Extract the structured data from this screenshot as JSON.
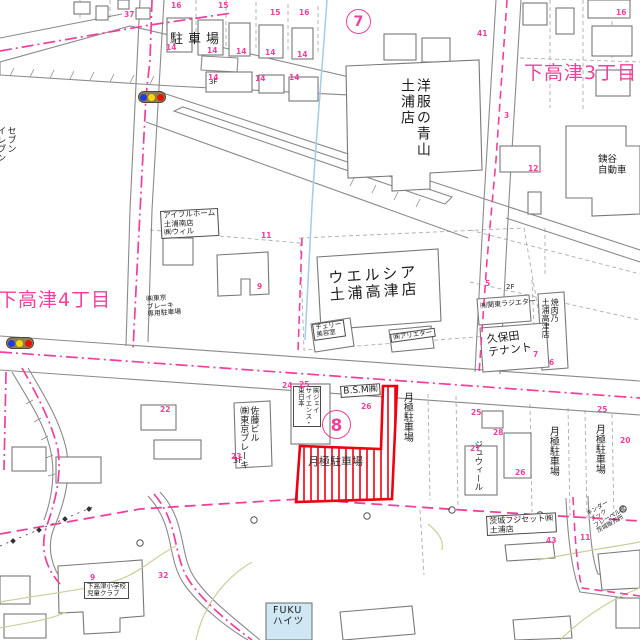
{
  "map": {
    "kind": "japanese residential map (Tsuchiura, Shimotakatsu area)",
    "highlight": "red hatched parcel - monthly parking lot"
  },
  "colors": {
    "pink": "#f23f9b",
    "red": "#ee0011",
    "text": "#1c1c1c",
    "dark": "#333333",
    "contour": "#cdcd9b",
    "water": "#a9cde8",
    "building_fill": "#cfe7f3",
    "signal_body": "#8d7f52",
    "signal_blue": "#1e3de0",
    "signal_yellow": "#f5d800",
    "signal_red": "#e81500"
  },
  "labels": [
    {
      "text": "駐車場",
      "x": 170,
      "y": 33,
      "size": 13,
      "ls": 5
    },
    {
      "text": "洋服の青山\n土浦店",
      "x": 398,
      "y": 78,
      "size": 14,
      "vertical": true,
      "ls": 2
    },
    {
      "text": "下高津3丁目",
      "x": 524,
      "y": 63,
      "size": 19,
      "color": "pink",
      "ls": 1
    },
    {
      "text": "下高津4丁目",
      "x": -2,
      "y": 290,
      "size": 19,
      "color": "pink",
      "ls": 1
    },
    {
      "text": "セブン\nイレブン",
      "x": -5,
      "y": 126,
      "size": 9,
      "vertical": true
    },
    {
      "text": "アイフルホーム\n土浦南店\n㈱ウィル",
      "x": 160,
      "y": 211,
      "size": 7.5,
      "boxed": true,
      "rot": -3
    },
    {
      "text": "ウエルシア\n土浦高津店",
      "x": 328,
      "y": 270,
      "size": 15,
      "ls": 3,
      "rot": -4,
      "align": "center"
    },
    {
      "text": "チェリー\n美容室",
      "x": 312,
      "y": 324,
      "size": 6.5,
      "boxed": true,
      "rot": -8
    },
    {
      "text": "㈱アリエター",
      "x": 390,
      "y": 334,
      "size": 6.5,
      "boxed": true,
      "rot": -8
    },
    {
      "text": "㈲関東ラジエター",
      "x": 480,
      "y": 303,
      "size": 7,
      "rot": -5
    },
    {
      "text": "焼肉乃\n土浦高津店",
      "x": 541,
      "y": 298,
      "size": 8,
      "vertical": true
    },
    {
      "text": "久保田\nテナント",
      "x": 486,
      "y": 334,
      "size": 11,
      "rot": -7
    },
    {
      "text": "銕谷\n自動車",
      "x": 598,
      "y": 155,
      "size": 9.5
    },
    {
      "text": "B.S.M㈱",
      "x": 340,
      "y": 386,
      "size": 9,
      "boxed": true,
      "rot": -4
    },
    {
      "text": "㈱ジェイ\nサイエンス・\n東日本",
      "x": 293,
      "y": 386,
      "size": 6.5,
      "vertical": true,
      "boxed": true
    },
    {
      "text": "月極駐車場",
      "x": 401,
      "y": 392,
      "size": 10,
      "vertical": true
    },
    {
      "text": "月極駐車場",
      "x": 308,
      "y": 456,
      "size": 11,
      "color": "dark"
    },
    {
      "text": "月極駐車場",
      "x": 547,
      "y": 426,
      "size": 10,
      "vertical": true
    },
    {
      "text": "月極駐車場",
      "x": 593,
      "y": 424,
      "size": 10,
      "vertical": true
    },
    {
      "text": "ジュウィール",
      "x": 472,
      "y": 440,
      "size": 8.5,
      "vertical": true
    },
    {
      "text": "佐藤ビル\n㈱東京ブレーキ",
      "x": 238,
      "y": 406,
      "size": 9,
      "vertical": true
    },
    {
      "text": "3F",
      "x": 233,
      "y": 456,
      "size": 8
    },
    {
      "text": "㈱東京\nブレーキ\n専用駐車場",
      "x": 146,
      "y": 296,
      "size": 6.8,
      "rot": -4
    },
    {
      "text": "茨城フジセット㈱\n土浦店",
      "x": 486,
      "y": 516,
      "size": 8,
      "boxed": true,
      "rot": -3
    },
    {
      "text": "キンダー\nブック\nフレーベル館\n茨城販売所",
      "x": 586,
      "y": 512,
      "size": 6,
      "rot": -30
    },
    {
      "text": "FUKU\nハイツ",
      "x": 273,
      "y": 606,
      "size": 9.5,
      "ls": 1
    },
    {
      "text": "下高津小学校\n児童クラブ",
      "x": 84,
      "y": 582,
      "size": 6.5,
      "boxed": true
    },
    {
      "text": "2F",
      "x": 506,
      "y": 284,
      "size": 7
    },
    {
      "text": "3F",
      "x": 209,
      "y": 79,
      "size": 7
    }
  ],
  "pink_numbers": [
    {
      "text": "37",
      "x": 124,
      "y": 11
    },
    {
      "text": "16",
      "x": 171,
      "y": 2
    },
    {
      "text": "15",
      "x": 218,
      "y": 2
    },
    {
      "text": "15",
      "x": 270,
      "y": 9
    },
    {
      "text": "16",
      "x": 299,
      "y": 9
    },
    {
      "text": "16",
      "x": 616,
      "y": 9
    },
    {
      "text": "14",
      "x": 166,
      "y": 44
    },
    {
      "text": "14",
      "x": 207,
      "y": 47
    },
    {
      "text": "14",
      "x": 236,
      "y": 48
    },
    {
      "text": "14",
      "x": 265,
      "y": 49
    },
    {
      "text": "14",
      "x": 297,
      "y": 51
    },
    {
      "text": "14",
      "x": 208,
      "y": 74
    },
    {
      "text": "14",
      "x": 255,
      "y": 75
    },
    {
      "text": "14",
      "x": 289,
      "y": 74
    },
    {
      "text": "41",
      "x": 477,
      "y": 30
    },
    {
      "text": "3",
      "x": 504,
      "y": 112
    },
    {
      "text": "12",
      "x": 528,
      "y": 165
    },
    {
      "text": "5",
      "x": 485,
      "y": 280
    },
    {
      "text": "7",
      "x": 533,
      "y": 351
    },
    {
      "text": "6",
      "x": 549,
      "y": 359
    },
    {
      "text": "11",
      "x": 261,
      "y": 232
    },
    {
      "text": "9",
      "x": 257,
      "y": 283
    },
    {
      "text": "22",
      "x": 160,
      "y": 406
    },
    {
      "text": "23",
      "x": 231,
      "y": 453
    },
    {
      "text": "24",
      "x": 282,
      "y": 382
    },
    {
      "text": "25",
      "x": 299,
      "y": 381
    },
    {
      "text": "26",
      "x": 361,
      "y": 403
    },
    {
      "text": "25",
      "x": 471,
      "y": 409
    },
    {
      "text": "28",
      "x": 493,
      "y": 429
    },
    {
      "text": "27",
      "x": 470,
      "y": 445
    },
    {
      "text": "26",
      "x": 515,
      "y": 469
    },
    {
      "text": "25",
      "x": 597,
      "y": 406
    },
    {
      "text": "20",
      "x": 620,
      "y": 437
    },
    {
      "text": "43",
      "x": 546,
      "y": 537
    },
    {
      "text": "11",
      "x": 580,
      "y": 534
    },
    {
      "text": "9",
      "x": 90,
      "y": 574
    },
    {
      "text": "32",
      "x": 158,
      "y": 572
    }
  ],
  "circled_numbers": [
    {
      "text": "7",
      "x": 346,
      "y": 9,
      "d": 23
    },
    {
      "text": "8",
      "x": 322,
      "y": 410,
      "d": 27
    }
  ],
  "traffic_lights": [
    {
      "x": 138,
      "y": 91
    },
    {
      "x": 6,
      "y": 337
    }
  ]
}
